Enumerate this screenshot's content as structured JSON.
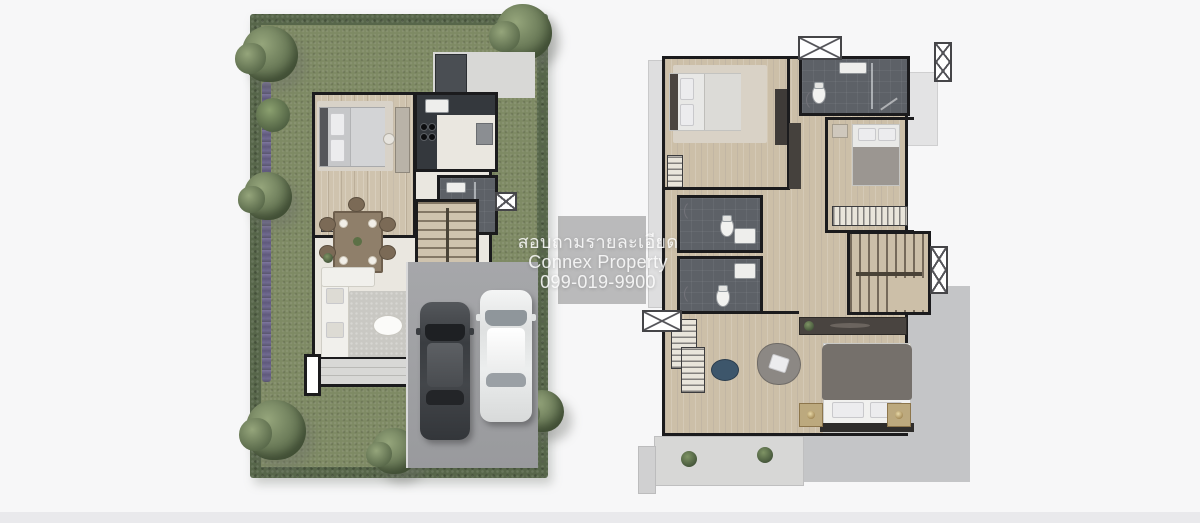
{
  "watermark": {
    "line1": "สอบถามรายละเอียด",
    "line2": "Connex Property",
    "line3": "099-019-9900"
  },
  "palette": {
    "page_bg": "#f7f7f8",
    "bottom_strip": "#e9e9ec",
    "hedge_green": "#57664a",
    "grass_green": "#7e8a64",
    "flower_purple": "#6f6796",
    "tree_light": "#95a57b",
    "tree_dark": "#59694a",
    "wall_black": "#1b1b1d",
    "floor_cream": "#eae7e0",
    "wood_floor_1f": "#cfc3ae",
    "wood_floor_2f": "#ccbfa8",
    "bath_tile_dark": "#5d6167",
    "kitchen_counter": "#34383d",
    "concrete_pad": "#d8d8d6",
    "driveway_gray": "#a0a1a4",
    "terrace_gray": "#c4c5c7",
    "balcony_gray": "#d7d7d6",
    "car_dark": "#43464a",
    "car_white": "#f1f2f1",
    "rug_gray": "#c9c8c3",
    "watermark_overlay": "rgba(125,125,125,0.5)",
    "watermark_text": "rgba(255,255,255,0.85)"
  }
}
